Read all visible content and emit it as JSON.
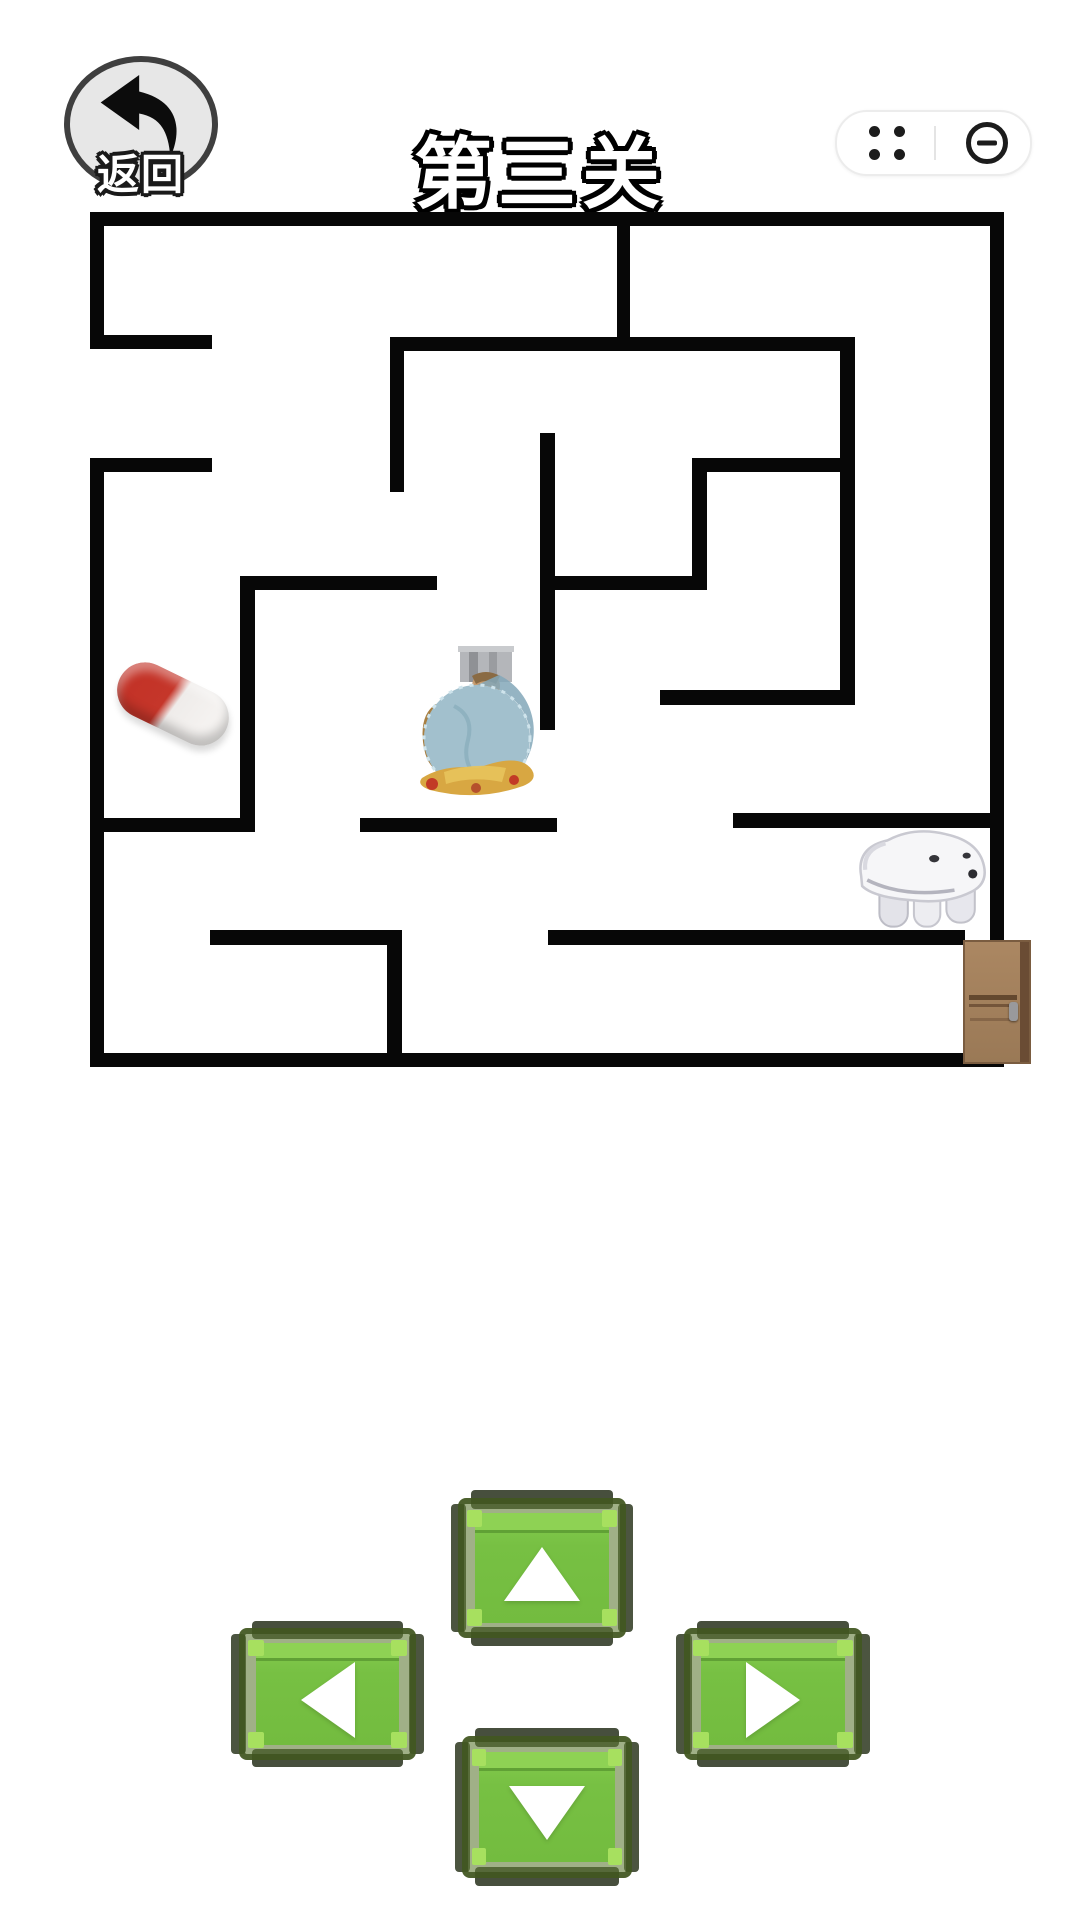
{
  "header": {
    "back": {
      "label": "返回"
    },
    "title": {
      "text": "第三关"
    },
    "capsule": {
      "menu_icon": "four-dots-menu",
      "minimize_icon": "minus-in-circle"
    }
  },
  "maze": {
    "wall_color": "#070707",
    "walls": [
      {
        "x": 90,
        "y": 212,
        "w": 914,
        "h": 14
      },
      {
        "x": 90,
        "y": 1053,
        "w": 914,
        "h": 14
      },
      {
        "x": 90,
        "y": 212,
        "w": 14,
        "h": 136
      },
      {
        "x": 90,
        "y": 458,
        "w": 14,
        "h": 609
      },
      {
        "x": 990,
        "y": 212,
        "w": 14,
        "h": 855
      },
      {
        "x": 90,
        "y": 335,
        "w": 122,
        "h": 14
      },
      {
        "x": 90,
        "y": 458,
        "w": 122,
        "h": 14
      },
      {
        "x": 390,
        "y": 337,
        "w": 465,
        "h": 14
      },
      {
        "x": 390,
        "y": 337,
        "w": 14,
        "h": 155
      },
      {
        "x": 617,
        "y": 212,
        "w": 13,
        "h": 126
      },
      {
        "x": 840,
        "y": 337,
        "w": 15,
        "h": 368
      },
      {
        "x": 660,
        "y": 690,
        "w": 195,
        "h": 15
      },
      {
        "x": 692,
        "y": 458,
        "w": 163,
        "h": 14
      },
      {
        "x": 692,
        "y": 458,
        "w": 15,
        "h": 132
      },
      {
        "x": 540,
        "y": 576,
        "w": 167,
        "h": 14
      },
      {
        "x": 540,
        "y": 433,
        "w": 15,
        "h": 297
      },
      {
        "x": 240,
        "y": 576,
        "w": 197,
        "h": 14
      },
      {
        "x": 240,
        "y": 576,
        "w": 15,
        "h": 256
      },
      {
        "x": 90,
        "y": 818,
        "w": 165,
        "h": 14
      },
      {
        "x": 360,
        "y": 818,
        "w": 197,
        "h": 14
      },
      {
        "x": 733,
        "y": 813,
        "w": 271,
        "h": 15
      },
      {
        "x": 210,
        "y": 930,
        "w": 192,
        "h": 15
      },
      {
        "x": 387,
        "y": 930,
        "w": 15,
        "h": 137
      },
      {
        "x": 548,
        "y": 930,
        "w": 417,
        "h": 15
      }
    ],
    "items": {
      "pill": {
        "x": 110,
        "y": 658,
        "w": 126,
        "h": 92,
        "desc": "red-white capsule pickup"
      },
      "statue": {
        "x": 414,
        "y": 646,
        "w": 126,
        "h": 152,
        "desc": "seated figure statue (player)"
      },
      "creature": {
        "x": 851,
        "y": 829,
        "w": 138,
        "h": 104,
        "desc": "white animal"
      },
      "door": {
        "x": 963,
        "y": 940,
        "w": 68,
        "h": 124,
        "desc": "wooden exit door"
      }
    }
  },
  "controls": {
    "face_color": "#77c043",
    "frame_color": "#40541f",
    "arrow_color": "#ffffff",
    "buttons": [
      {
        "id": "up",
        "dir": "up",
        "x": 451,
        "y": 1490,
        "w": 182,
        "h": 156
      },
      {
        "id": "left",
        "dir": "left",
        "x": 231,
        "y": 1621,
        "w": 193,
        "h": 146
      },
      {
        "id": "right",
        "dir": "right",
        "x": 676,
        "y": 1621,
        "w": 194,
        "h": 146
      },
      {
        "id": "down",
        "dir": "down",
        "x": 455,
        "y": 1728,
        "w": 184,
        "h": 158
      }
    ]
  }
}
